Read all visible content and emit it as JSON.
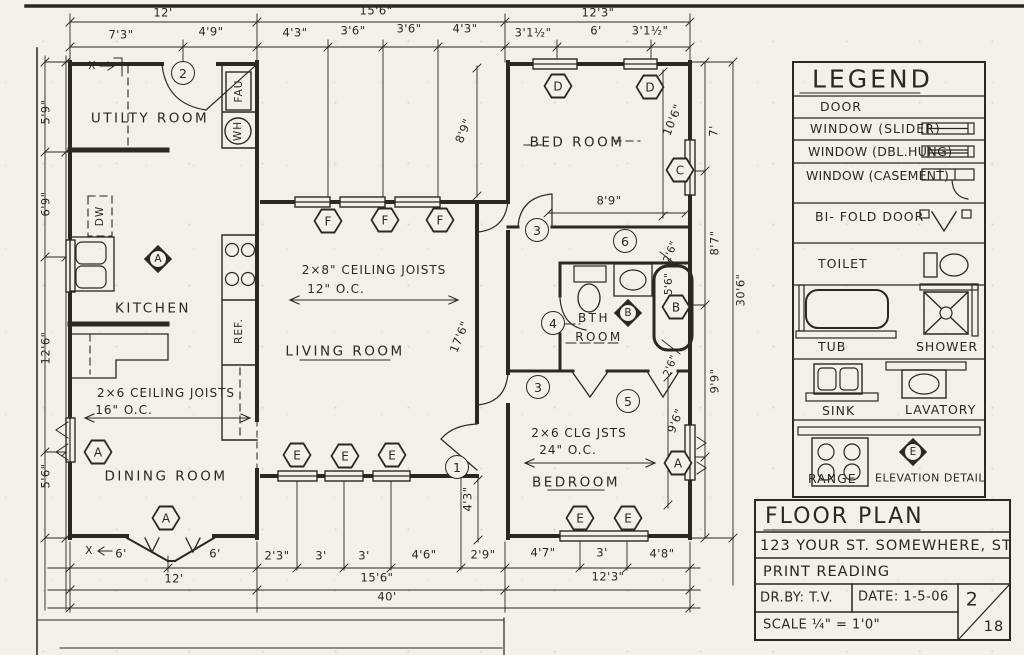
{
  "colors": {
    "paper": "#f2f0e9",
    "ink": "#2b2722"
  },
  "dims": {
    "top_major": [
      "12'",
      "15'6\"",
      "12'3\""
    ],
    "top_minor": [
      "7'3\"",
      "4'9\"",
      "4'3\"",
      "3'6\"",
      "3'6\"",
      "4'3\"",
      "3'1½\"",
      "6'",
      "3'1½\""
    ],
    "bottom_minor": [
      "6'",
      "6'",
      "2'3\"",
      "3'",
      "3'",
      "4'6\"",
      "2'9\"",
      "4'7\"",
      "3'",
      "4'8\""
    ],
    "bottom_major": [
      "12'",
      "15'6\"",
      "12'3\""
    ],
    "total_width": "40'",
    "left": [
      "5'9\"",
      "6'9\"",
      "12'6\"",
      "5'6\""
    ],
    "right": [
      "7'",
      "8'7\"",
      "9'9\""
    ],
    "right_total": "30'6\"",
    "interior": {
      "porch_depth": "8'9\"",
      "living_depth": "17'6\"",
      "bed_width": "8'9\"",
      "bed_depth": "10'6\"",
      "closet_a": "2'6\"",
      "closet_b": "2'6\"",
      "tub_length": "5'6\"",
      "bedroom_depth": "9'6\"",
      "entry": "4'3\""
    }
  },
  "rooms": {
    "utility": "UTILTY ROOM",
    "kitchen": "KITCHEN",
    "dining": "DINING ROOM",
    "living": "LIVING ROOM",
    "bed": "BED ROOM",
    "bath_line1": "BTH",
    "bath_line2": "ROOM",
    "bedroom": "BEDROOM"
  },
  "notes": {
    "living_joists": "2×8\" CEILING JOISTS",
    "living_spacing": "12\" O.C.",
    "dining_joists": "2×6 CEILING JOISTS",
    "dining_spacing": "16\" O.C.",
    "bedroom_joists": "2×6 CLG JSTS",
    "bedroom_spacing": "24\" O.C."
  },
  "equipment": {
    "fau": "FAU",
    "wh": "WH",
    "dw": "DW",
    "ref": "REF."
  },
  "marks": {
    "x": "X"
  },
  "markers": {
    "door_entry": "1",
    "door_utility": "2",
    "door_bed": "3",
    "door_bedroom": "3",
    "bath": "4",
    "bedroom": "5",
    "hall": "6",
    "hex_a": "A",
    "hex_b": "B",
    "hex_c": "C",
    "hex_d": "D",
    "hex_e": "E",
    "hex_f": "F",
    "elev_a": "A",
    "elev_b": "B",
    "elev_e": "E"
  },
  "legend": {
    "title": "LEGEND",
    "door": "DOOR",
    "window_slider": "WINDOW (SLIDER)",
    "window_dbl_hung": "WINDOW (DBL.HUNG)",
    "window_casement": "WINDOW (CASEMENT)",
    "bifold_door": "BI- FOLD DOOR",
    "toilet": "TOILET",
    "tub": "TUB",
    "shower": "SHOWER",
    "sink": "SINK",
    "lavatory": "LAVATORY",
    "range": "RANGE",
    "elevation_detail": "ELEVATION DETAIL"
  },
  "titleblock": {
    "title": "FLOOR PLAN",
    "address": "123 YOUR ST.  SOMEWHERE, ST",
    "subtitle": "PRINT READING",
    "drawn_by": "DR.BY: T.V.",
    "date": "DATE: 1-5-06",
    "scale": "SCALE ¼\" = 1'0\"",
    "sheet_number": "2",
    "sheet_total": "18"
  }
}
